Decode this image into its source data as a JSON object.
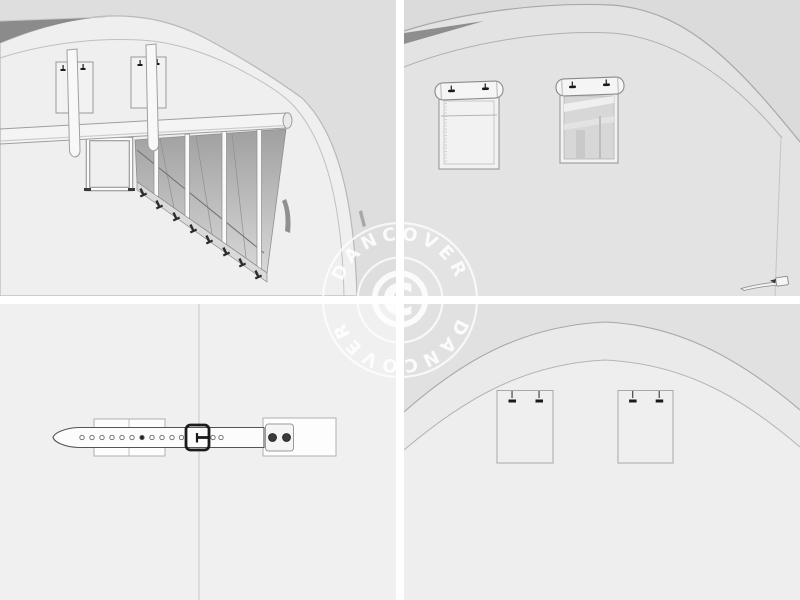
{
  "watermark": {
    "brand_top": "DANCOVER",
    "brand_bottom": "DANCOVER",
    "symbol": "©",
    "color": "#ffffff"
  },
  "colors": {
    "page_background": "#ffffff",
    "divider": "#ffffff",
    "tl_outside": "#dedede",
    "tl_wall": "#efefef",
    "tl_roof_wedge": "#8b8b8b",
    "tl_interior_dark": "#a0a0a0",
    "tl_interior_light": "#d8d8d8",
    "tl_rail": "#dadada",
    "anchor_dark": "#2c2c2c",
    "tr_wall": "#e3e3e3",
    "tr_top": "#dbdbdb",
    "tr_roof_sliver": "#8e8e8e",
    "tr_window_panel": "#f2f2f2",
    "tr_window_interior": "#d7d7d7",
    "bl_background": "#f0f0f0",
    "bl_strap_fill": "#fcfcfc",
    "bl_buckle": "#1b1b1b",
    "bl_rivet": "#3a3a3a",
    "br_wall": "#eeeeee",
    "br_top": "#e1e1e1",
    "br_band": "#eaeaea",
    "clip_dark": "#1a1a1a",
    "outline": "#9a9a9a"
  }
}
